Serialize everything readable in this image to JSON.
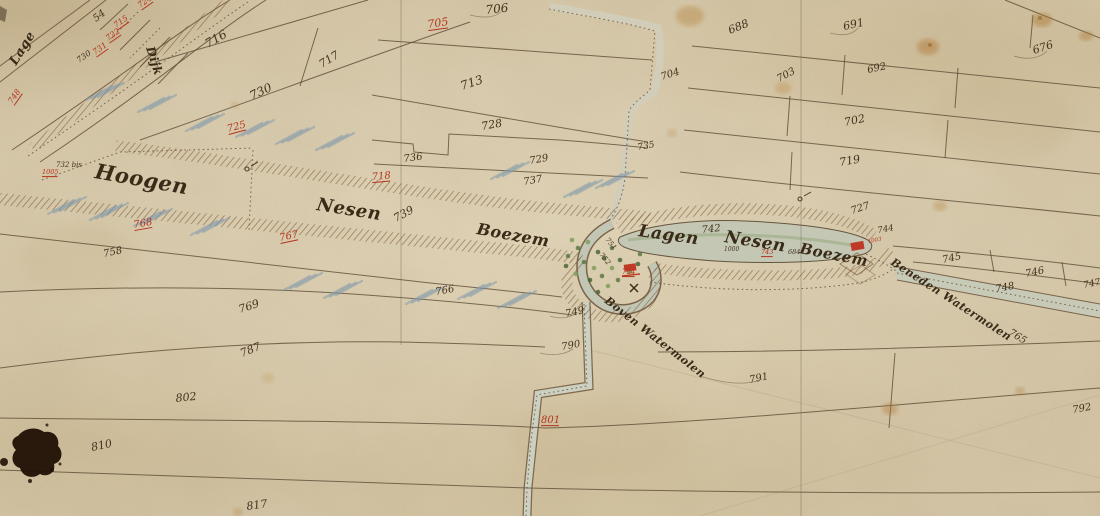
{
  "map_type": "historical-polder-parcel-map",
  "palette": {
    "paper": "#d5c7a8",
    "ink_brown": "#5e4c36",
    "accent_red": "#b5341f",
    "water_gray_green": "#c2c7b5",
    "vegetation_green": "#55743d",
    "blue_wash": "#7e98ab"
  },
  "script_labels": [
    {
      "text": "Lage",
      "x": 16,
      "y": 66,
      "rot": -58,
      "size": 13
    },
    {
      "text": "Dijk",
      "x": 146,
      "y": 48,
      "rot": 72,
      "size": 12
    },
    {
      "text": "Hoogen",
      "x": 94,
      "y": 178,
      "rot": 10,
      "size": 21
    },
    {
      "text": "Nesen",
      "x": 316,
      "y": 210,
      "rot": 9,
      "size": 18
    },
    {
      "text": "Boezem",
      "x": 476,
      "y": 234,
      "rot": 10,
      "size": 16
    },
    {
      "text": "Lagen",
      "x": 638,
      "y": 236,
      "rot": 8,
      "size": 17
    },
    {
      "text": "Nesen",
      "x": 724,
      "y": 242,
      "rot": 9,
      "size": 17
    },
    {
      "text": "Boezem",
      "x": 799,
      "y": 253,
      "rot": 11,
      "size": 15
    },
    {
      "text": "Boven Watermolen",
      "x": 604,
      "y": 302,
      "rot": 38,
      "size": 11
    },
    {
      "text": "Beneden Watermolen",
      "x": 890,
      "y": 264,
      "rot": 33,
      "size": 11
    }
  ],
  "parcel_numbers": [
    {
      "text": "54",
      "x": 96,
      "y": 22,
      "rot": -38,
      "size": 10
    },
    {
      "text": "706",
      "x": 486,
      "y": 14,
      "rot": -6,
      "size": 12
    },
    {
      "text": "705",
      "x": 428,
      "y": 28,
      "rot": -8,
      "size": 11,
      "red": true,
      "ul": true
    },
    {
      "text": "716",
      "x": 208,
      "y": 48,
      "rot": -30,
      "size": 12
    },
    {
      "text": "717",
      "x": 322,
      "y": 68,
      "rot": -32,
      "size": 11
    },
    {
      "text": "730",
      "x": 252,
      "y": 100,
      "rot": -25,
      "size": 12
    },
    {
      "text": "725",
      "x": 228,
      "y": 132,
      "rot": -15,
      "size": 10,
      "red": true,
      "ul": true
    },
    {
      "text": "713",
      "x": 462,
      "y": 90,
      "rot": -18,
      "size": 12
    },
    {
      "text": "728",
      "x": 482,
      "y": 130,
      "rot": -10,
      "size": 11
    },
    {
      "text": "736",
      "x": 404,
      "y": 162,
      "rot": -8,
      "size": 10
    },
    {
      "text": "729",
      "x": 530,
      "y": 164,
      "rot": -10,
      "size": 10
    },
    {
      "text": "718",
      "x": 372,
      "y": 180,
      "rot": -5,
      "size": 10,
      "red": true,
      "ul": true
    },
    {
      "text": "737",
      "x": 524,
      "y": 185,
      "rot": -10,
      "size": 10
    },
    {
      "text": "704",
      "x": 662,
      "y": 80,
      "rot": -18,
      "size": 10
    },
    {
      "text": "735",
      "x": 638,
      "y": 150,
      "rot": -10,
      "size": 9
    },
    {
      "text": "688",
      "x": 730,
      "y": 34,
      "rot": -22,
      "size": 11
    },
    {
      "text": "691",
      "x": 844,
      "y": 30,
      "rot": -12,
      "size": 11
    },
    {
      "text": "676",
      "x": 1034,
      "y": 54,
      "rot": -18,
      "size": 11
    },
    {
      "text": "692",
      "x": 868,
      "y": 73,
      "rot": -12,
      "size": 10
    },
    {
      "text": "703",
      "x": 779,
      "y": 82,
      "rot": -28,
      "size": 10
    },
    {
      "text": "702",
      "x": 845,
      "y": 126,
      "rot": -12,
      "size": 11
    },
    {
      "text": "719",
      "x": 840,
      "y": 166,
      "rot": -10,
      "size": 11
    },
    {
      "text": "727",
      "x": 852,
      "y": 214,
      "rot": -18,
      "size": 10
    },
    {
      "text": "744",
      "x": 878,
      "y": 233,
      "rot": -10,
      "size": 8.5
    },
    {
      "text": "745",
      "x": 943,
      "y": 263,
      "rot": -12,
      "size": 10
    },
    {
      "text": "746",
      "x": 1026,
      "y": 277,
      "rot": -12,
      "size": 10
    },
    {
      "text": "747",
      "x": 1084,
      "y": 288,
      "rot": -12,
      "size": 9
    },
    {
      "text": "748",
      "x": 996,
      "y": 292,
      "rot": -10,
      "size": 10
    },
    {
      "text": "742",
      "x": 702,
      "y": 233,
      "rot": -6,
      "size": 10
    },
    {
      "text": "739",
      "x": 396,
      "y": 222,
      "rot": -28,
      "size": 11
    },
    {
      "text": "767",
      "x": 280,
      "y": 241,
      "rot": -12,
      "size": 10,
      "red": true,
      "ul": true
    },
    {
      "text": "768",
      "x": 134,
      "y": 228,
      "rot": -10,
      "size": 10,
      "red": true,
      "ul": true
    },
    {
      "text": "766",
      "x": 436,
      "y": 295,
      "rot": -10,
      "size": 10
    },
    {
      "text": "758",
      "x": 104,
      "y": 257,
      "rot": -12,
      "size": 10
    },
    {
      "text": "749",
      "x": 566,
      "y": 317,
      "rot": -12,
      "size": 10
    },
    {
      "text": "790",
      "x": 562,
      "y": 350,
      "rot": -10,
      "size": 10
    },
    {
      "text": "769",
      "x": 240,
      "y": 313,
      "rot": -18,
      "size": 11
    },
    {
      "text": "787",
      "x": 242,
      "y": 357,
      "rot": -22,
      "size": 11
    },
    {
      "text": "791",
      "x": 750,
      "y": 383,
      "rot": -12,
      "size": 10
    },
    {
      "text": "802",
      "x": 176,
      "y": 402,
      "rot": -6,
      "size": 11
    },
    {
      "text": "810",
      "x": 92,
      "y": 451,
      "rot": -12,
      "size": 11
    },
    {
      "text": "801",
      "x": 541,
      "y": 423,
      "rot": 0,
      "size": 10,
      "red": true,
      "ul": true
    },
    {
      "text": "817",
      "x": 247,
      "y": 510,
      "rot": -8,
      "size": 11
    },
    {
      "text": "792",
      "x": 1073,
      "y": 413,
      "rot": -10,
      "size": 10
    },
    {
      "text": "765",
      "x": 1008,
      "y": 334,
      "rot": 32,
      "size": 10
    },
    {
      "text": "724",
      "x": 140,
      "y": 8,
      "rot": -35,
      "size": 8,
      "red": true,
      "ul": true
    },
    {
      "text": "715",
      "x": 116,
      "y": 28,
      "rot": -35,
      "size": 8,
      "red": true,
      "ul": true
    },
    {
      "text": "722",
      "x": 108,
      "y": 41,
      "rot": -35,
      "size": 8,
      "red": true,
      "ul": true
    },
    {
      "text": "731",
      "x": 95,
      "y": 55,
      "rot": -35,
      "size": 8,
      "red": true,
      "ul": true
    },
    {
      "text": "730",
      "x": 79,
      "y": 63,
      "rot": -35,
      "size": 8
    },
    {
      "text": "748",
      "x": 12,
      "y": 104,
      "rot": -55,
      "size": 8,
      "red": true,
      "ul": true
    },
    {
      "text": "732 bis",
      "x": 56,
      "y": 167,
      "rot": 0,
      "size": 7
    },
    {
      "text": "1005",
      "x": 42,
      "y": 174,
      "rot": 0,
      "size": 6.5,
      "red": true,
      "ul": true
    },
    {
      "text": "1000",
      "x": 724,
      "y": 251,
      "rot": 0,
      "size": 6
    },
    {
      "text": "743",
      "x": 761,
      "y": 254,
      "rot": 0,
      "size": 6.5,
      "red": true,
      "ul": true
    },
    {
      "text": "684",
      "x": 788,
      "y": 254,
      "rot": 0,
      "size": 6.5
    },
    {
      "text": "784",
      "x": 622,
      "y": 274,
      "rot": 0,
      "size": 7,
      "red": true,
      "ul": true
    },
    {
      "text": "1003",
      "x": 868,
      "y": 243,
      "rot": -10,
      "size": 5.5,
      "red": true
    },
    {
      "text": "751",
      "x": 605,
      "y": 240,
      "rot": 50,
      "size": 7
    },
    {
      "text": "752",
      "x": 599,
      "y": 255,
      "rot": 50,
      "size": 7
    }
  ]
}
